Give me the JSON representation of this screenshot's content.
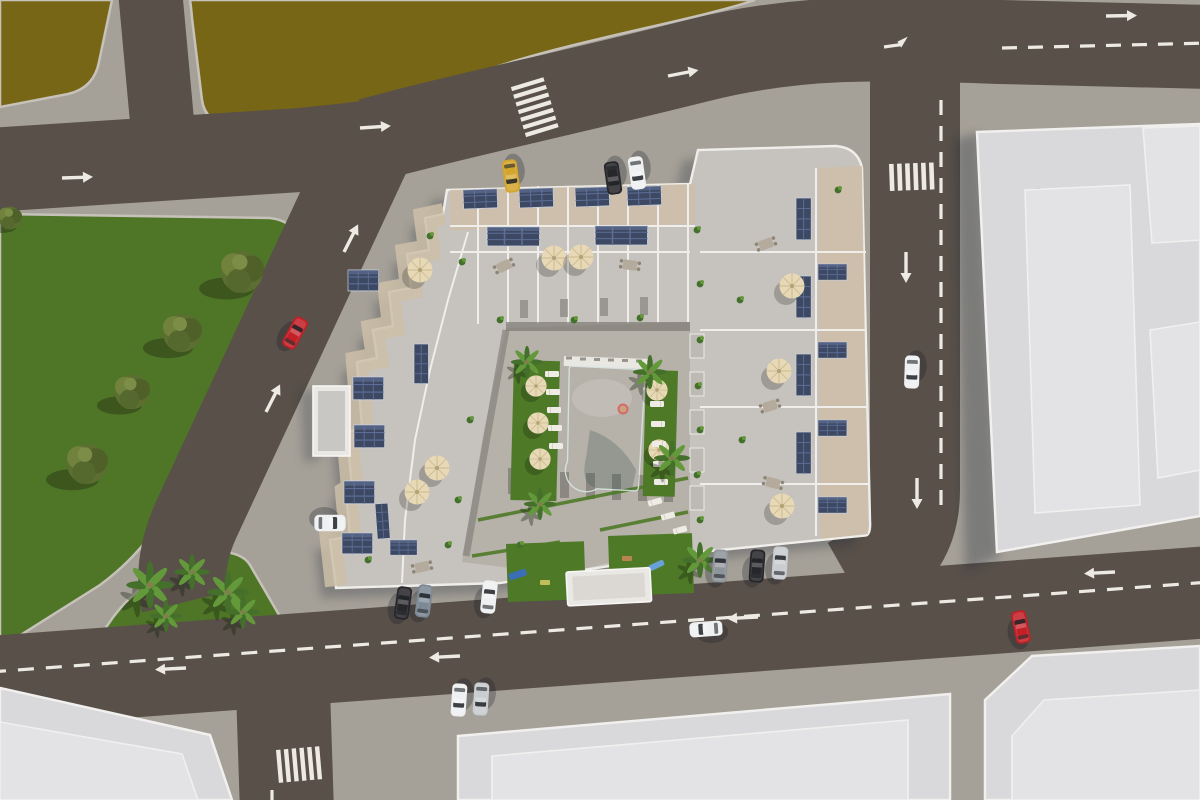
{
  "scene": {
    "description": "Aerial top-down 3D architectural rendering of a residential apartment complex with rooftop solar panels and terraces around a central courtyard with a swimming pool, lawns and palm trees, surrounded by streets with lane markings, crosswalks, parked and moving cars, a green park with trees, olive-brown vacant lots and neighboring white flat-roof buildings",
    "view": "bird's-eye",
    "lighting": "warm late-afternoon sun from upper right, long shadows to lower left"
  },
  "palette": {
    "pavement": "#a6a198",
    "road": "#585049",
    "field_olive": "#786617",
    "field_olive_dark": "#695913",
    "park_green": "#4f7527",
    "lawn_green": "#4e7a28",
    "pool_light": "#b8d6d2",
    "pool_deep": "#8bb0ae",
    "building_white": "#f1f0ee",
    "building_roof": "#d9d8da",
    "building_roof_light": "#e3e2e4",
    "building_face_blue": "#a9b6ca",
    "building_face_warm": "#d3c9bf",
    "complex_concrete": "#c6c2bd",
    "complex_gravel": "#cdbfa8",
    "complex_parapet": "#f0eeea",
    "courtyard_deck": "#b6b1a9",
    "inner_wall": "#7d7974",
    "solar": "#3d4963",
    "solar_stripe": "#5d6d96",
    "umbrella": "#e8d9b6",
    "umbrella_rib": "#cdbb92",
    "marking": "#eceae3",
    "curb": "#c6c2b9",
    "tree_olive": "#5c6e31",
    "tree_olive_light": "#71823c",
    "palm_green": "#44702c",
    "palm_green_light": "#63993a",
    "glass": "#1d2125",
    "shadow_color": "rgba(25,28,38,0.28)",
    "car_red": "#c22026",
    "car_yellow": "#d4a52c",
    "car_white": "#eef0f2",
    "car_silver": "#c9ccd0",
    "car_dark": "#26262b",
    "car_gray": "#8f949a",
    "car_blue": "#7c8894"
  },
  "objects": {
    "vehicles": [
      {
        "color": "red",
        "state": "driving",
        "location": "west diagonal street"
      },
      {
        "color": "red",
        "state": "driving",
        "location": "south street near east junction"
      },
      {
        "color": "white",
        "state": "driving",
        "location": "east vertical street"
      },
      {
        "color": "white",
        "state": "driving",
        "location": "south street center"
      },
      {
        "color": "white",
        "state": "driving",
        "location": "south street west pair"
      },
      {
        "color": "silver",
        "state": "driving",
        "location": "south street west pair"
      },
      {
        "color": "yellow",
        "state": "parked",
        "location": "north side of complex"
      },
      {
        "color": "dark",
        "state": "parked",
        "location": "north side of complex"
      },
      {
        "color": "white",
        "state": "parked",
        "location": "north side of complex"
      },
      {
        "color": "gray",
        "state": "parked",
        "location": "south side of east wing"
      },
      {
        "color": "dark",
        "state": "parked",
        "location": "south side of east wing"
      },
      {
        "color": "silver",
        "state": "parked",
        "location": "south side of east wing"
      },
      {
        "color": "dark",
        "state": "parked",
        "location": "south side of west wing"
      },
      {
        "color": "blue-gray",
        "state": "parked",
        "location": "south side of west wing"
      },
      {
        "color": "white",
        "state": "parked",
        "location": "south side of west wing"
      },
      {
        "color": "white van",
        "state": "parked",
        "location": "west edge of complex"
      }
    ],
    "trees": {
      "park_trees": 5,
      "island_palms": 5,
      "courtyard_palms": 5
    },
    "pool": {
      "shape": "rectangular with rounded entry steps",
      "swimmers": 1,
      "sun_loungers": 13
    },
    "umbrellas": 13,
    "solar_panel_arrays": 22,
    "road_markings": {
      "crosswalks": 3,
      "lane_arrows": 14,
      "dashed_center_lines": 4
    }
  }
}
